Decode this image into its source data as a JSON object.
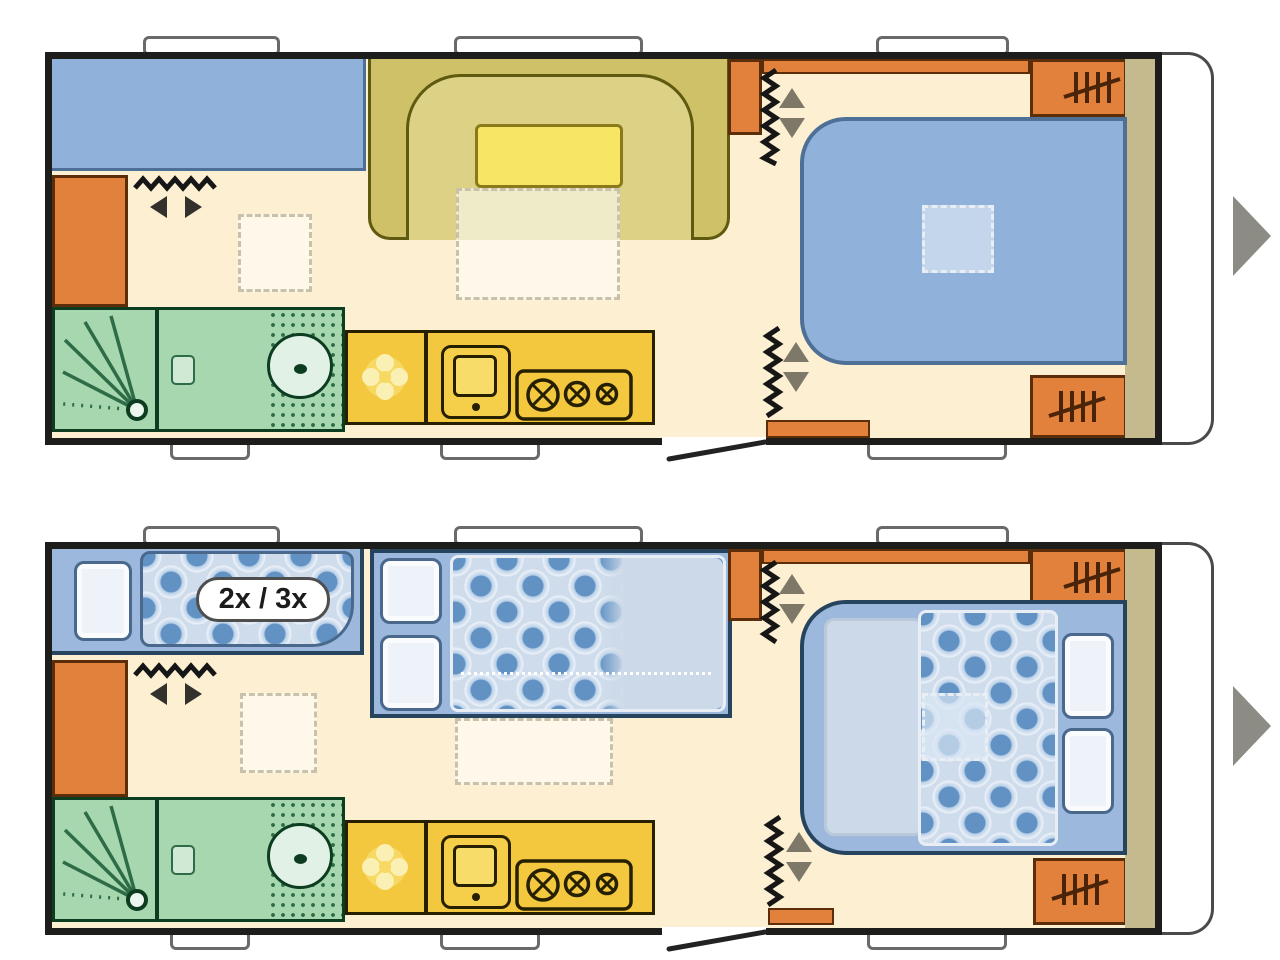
{
  "labels": {
    "bunk_capacity_badge": "2x / 3x"
  },
  "colors": {
    "wall": "#1d1d1b",
    "floor": "#fcefd2",
    "blue": "#8fb1da",
    "blueB": "#4f7096",
    "olive": "#cec167",
    "oliveL": "#dcd184",
    "oliveB": "#5f5a10",
    "tableY": "#f7e664",
    "orange": "#e2813c",
    "orangeB": "#5c2d09",
    "hatch": "#4a2408",
    "green": "#a6d7ae",
    "greenB": "#0d3d20",
    "greenM": "#2e6b47",
    "ky": "#f3c83f",
    "kyB": "#262000",
    "tan": "#c4ba8e",
    "nblue": "#9cb9dd",
    "nblueB": "#27445f",
    "florL": "#b9d0e8",
    "florD": "#6292c4",
    "pill": "#eef3fa",
    "pillB": "#49688c",
    "sheet": "#ccd9e8",
    "zig": "#161616",
    "arrT": "#7d7868",
    "arrD": "#33312c",
    "winB": "#6a6a6a",
    "nav": "#8c8c84",
    "frontB": "#4a4a4a",
    "dash": "#c9c2ab",
    "dashW": "#e9eef5",
    "badgeB": "#4e4e4e"
  },
  "plans": [
    {
      "name": "day-layout",
      "features": [
        "lounge-sofa",
        "u-shaped-dinette",
        "dinette-table",
        "table-extension-dashed",
        "wardrobe-left",
        "wardrobe-mid",
        "shelf-strip",
        "wardrobe-front-top",
        "wardrobe-front-bottom",
        "kitchen-fridge",
        "kitchen-sink",
        "kitchen-stove",
        "bathroom-shower",
        "bathroom-toilet",
        "bathroom-basin",
        "fixed-double-bed",
        "skylight-dashed",
        "privacy-curtains",
        "entry-door"
      ]
    },
    {
      "name": "night-layout",
      "bunk_badge": "2x / 3x",
      "features": [
        "bunk-bed-with-pillow",
        "bunk-duvet",
        "single-bed-two-pillows",
        "bed-extension-dashed",
        "wardrobe-left",
        "wardrobe-mid",
        "shelf-strip",
        "wardrobe-front-top",
        "wardrobe-front-bottom",
        "kitchen-fridge",
        "kitchen-sink",
        "kitchen-stove",
        "bathroom-shower",
        "bathroom-toilet",
        "bathroom-basin",
        "double-bed-made-up",
        "skylight-dashed",
        "privacy-curtains",
        "entry-door"
      ]
    }
  ],
  "nav": {
    "next_arrows": 2
  }
}
